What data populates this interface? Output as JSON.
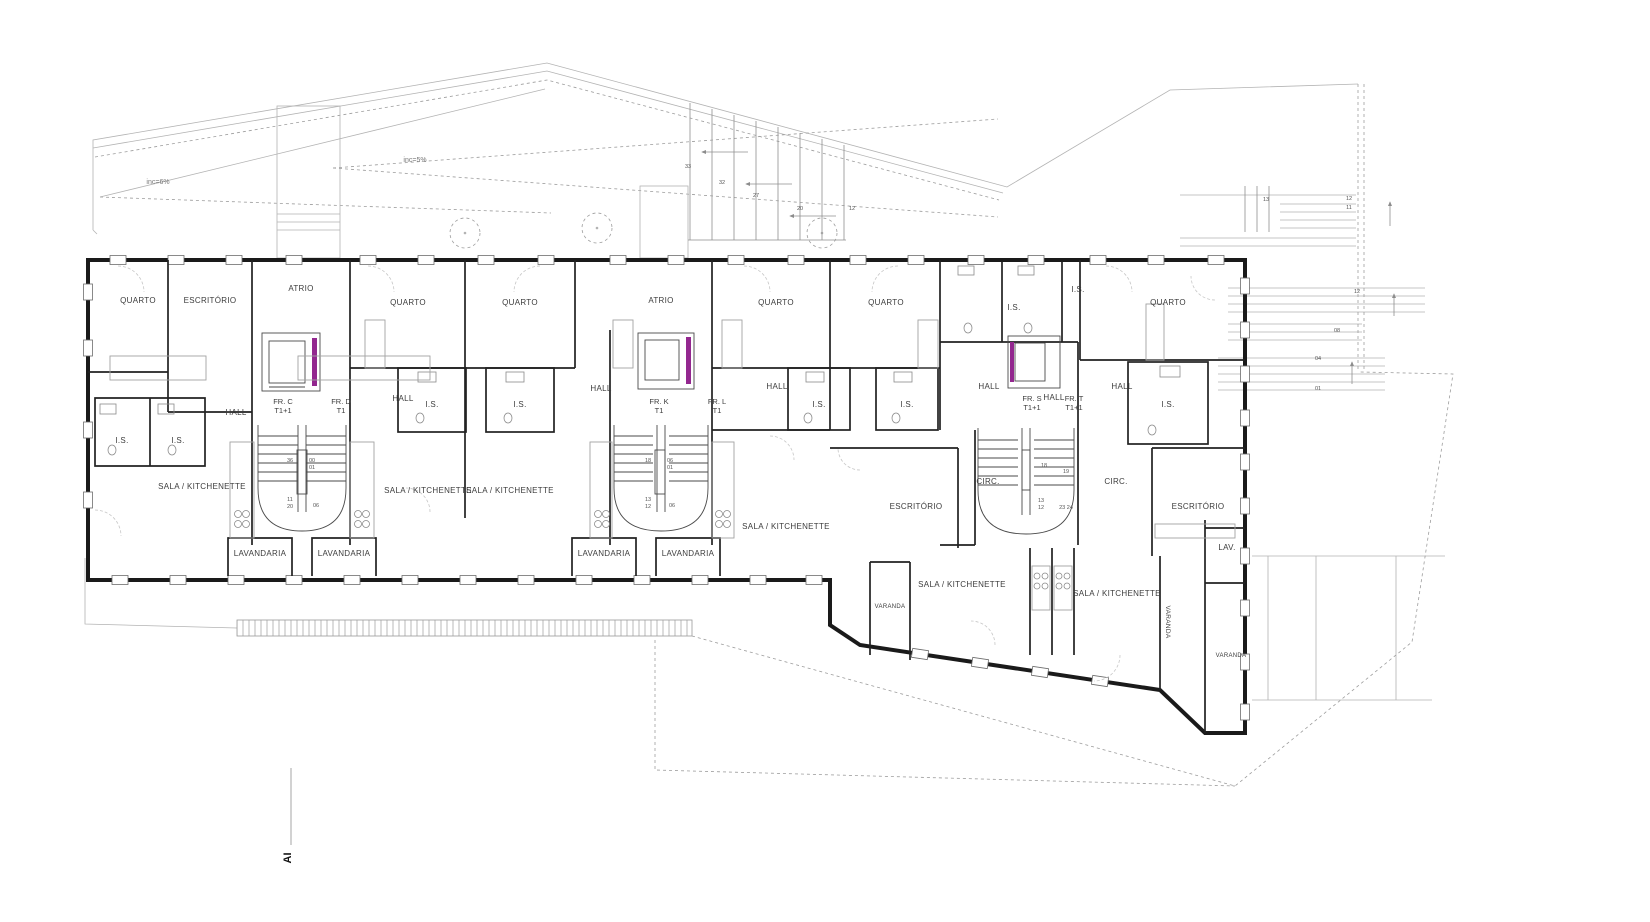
{
  "annotations": {
    "slope_left": "inc=6%",
    "slope_right": "inc=5%",
    "section_marker": "AI"
  },
  "room_labels": [
    "QUARTO",
    "ESCRITÓRIO",
    "ATRIO",
    "QUARTO",
    "QUARTO",
    "ATRIO",
    "QUARTO",
    "QUARTO",
    "I.S.",
    "QUARTO",
    "HALL",
    "I.S.",
    "I.S.",
    "SALA / KITCHENETTE",
    "LAVANDARIA",
    "LAVANDARIA",
    "HALL",
    "I.S.",
    "I.S.",
    "HALL",
    "SALA / KITCHENETTE",
    "SALA / KITCHENETTE",
    "LAVANDARIA",
    "LAVANDARIA",
    "HALL",
    "I.S.",
    "I.S.",
    "SALA / KITCHENETTE",
    "I.S.",
    "HALL",
    "HALL",
    "HALL",
    "I.S.",
    "ESCRITÓRIO",
    "CIRC.",
    "CIRC.",
    "ESCRITÓRIO",
    "LAV.",
    "VARANDA",
    "SALA / KITCHENETTE",
    "SALA / KITCHENETTE",
    "VARANDA",
    "VARANDA"
  ],
  "unit_labels": [
    {
      "code": "FR. C",
      "type": "T1+1"
    },
    {
      "code": "FR. D",
      "type": "T1"
    },
    {
      "code": "FR. K",
      "type": "T1"
    },
    {
      "code": "FR. L",
      "type": "T1"
    },
    {
      "code": "FR. S",
      "type": "T1+1"
    },
    {
      "code": "FR. T",
      "type": "T1+1"
    }
  ],
  "stair_numbers": {
    "roof_stair": [
      "33",
      "32",
      "27",
      "20",
      "12"
    ],
    "terrace_upper": [
      "13",
      "12",
      "11"
    ],
    "terrace_mid": [
      "12",
      "08"
    ],
    "terrace_lower": [
      "04",
      "01"
    ],
    "core_left": [
      "36",
      "00",
      "01",
      "11",
      "20",
      "06"
    ],
    "core_middle": [
      "18",
      "06",
      "01",
      "13",
      "12",
      "06"
    ],
    "core_right": [
      "18",
      "19",
      "13",
      "12",
      "23 24"
    ]
  },
  "colors": {
    "elevator_accent": "#93278f",
    "wall": "#1a1a1a"
  }
}
